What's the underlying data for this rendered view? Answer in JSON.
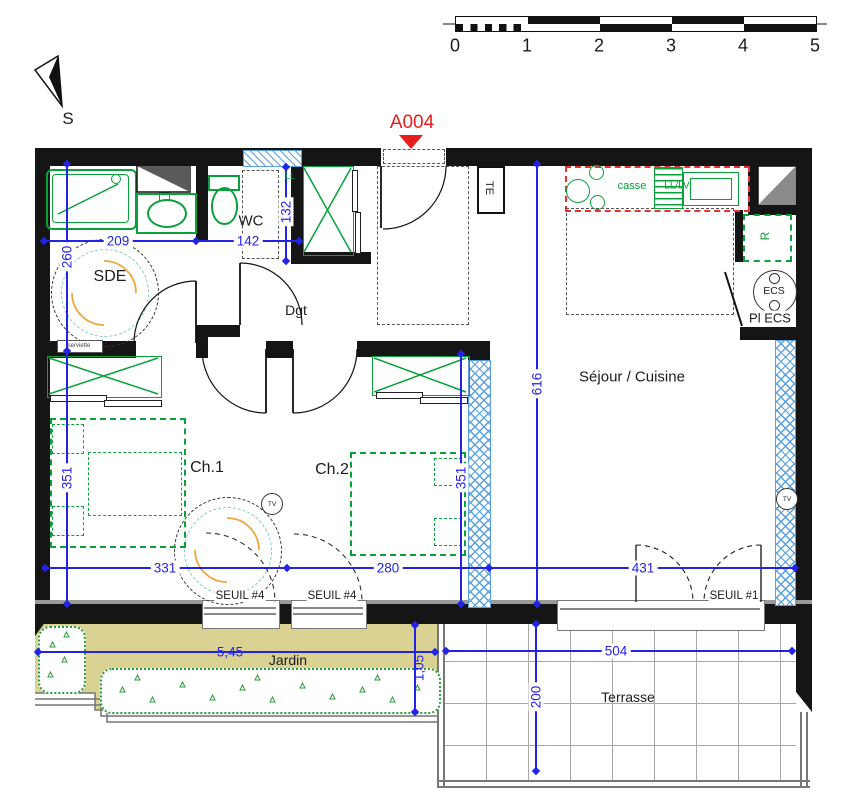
{
  "title": {
    "unit": "A004",
    "north": "S"
  },
  "scale_bar": {
    "ticks": [
      "0",
      "1",
      "2",
      "3",
      "4",
      "5"
    ]
  },
  "rooms": {
    "sde": "SDE",
    "wc": "WC",
    "dgt": "Dgt",
    "ch1": "Ch.1",
    "ch2": "Ch.2",
    "sejour": "Séjour / Cuisine",
    "pl_ecs": "Pl ECS",
    "jardin": "Jardin",
    "terrasse": "Terrasse"
  },
  "labels": {
    "te": "TE",
    "ll": "LL",
    "ecs": "ECS",
    "fridge_r": "R",
    "casse": "casse",
    "ll_lv": "LL/LV",
    "towel": "serviette",
    "tv1": "TV",
    "tv2": "TV",
    "seuil4_a": "SEUIL #4",
    "seuil4_b": "SEUIL #4",
    "seuil1": "SEUIL #1"
  },
  "dimensions": {
    "sde_width": "209",
    "wc_width": "142",
    "closet_depth": "132",
    "sde_depth": "260",
    "ch1_depth": "351",
    "ch2_depth": "351",
    "sejour_depth": "616",
    "ch1_width": "331",
    "ch2_width": "280",
    "sejour_width": "431",
    "jardin_width": "5,45",
    "jardin_depth": "1,05",
    "terrasse_width": "504",
    "terrasse_depth": "200"
  },
  "colors": {
    "dimension_blue": "#2323e8",
    "fixture_green": "#0aa03c",
    "kitchen_red": "#e63232",
    "marker_red": "#e81e1e",
    "hatch_blue": "#58a0e0",
    "jardin_khaki": "#d9d292",
    "wall_black": "#151515"
  }
}
